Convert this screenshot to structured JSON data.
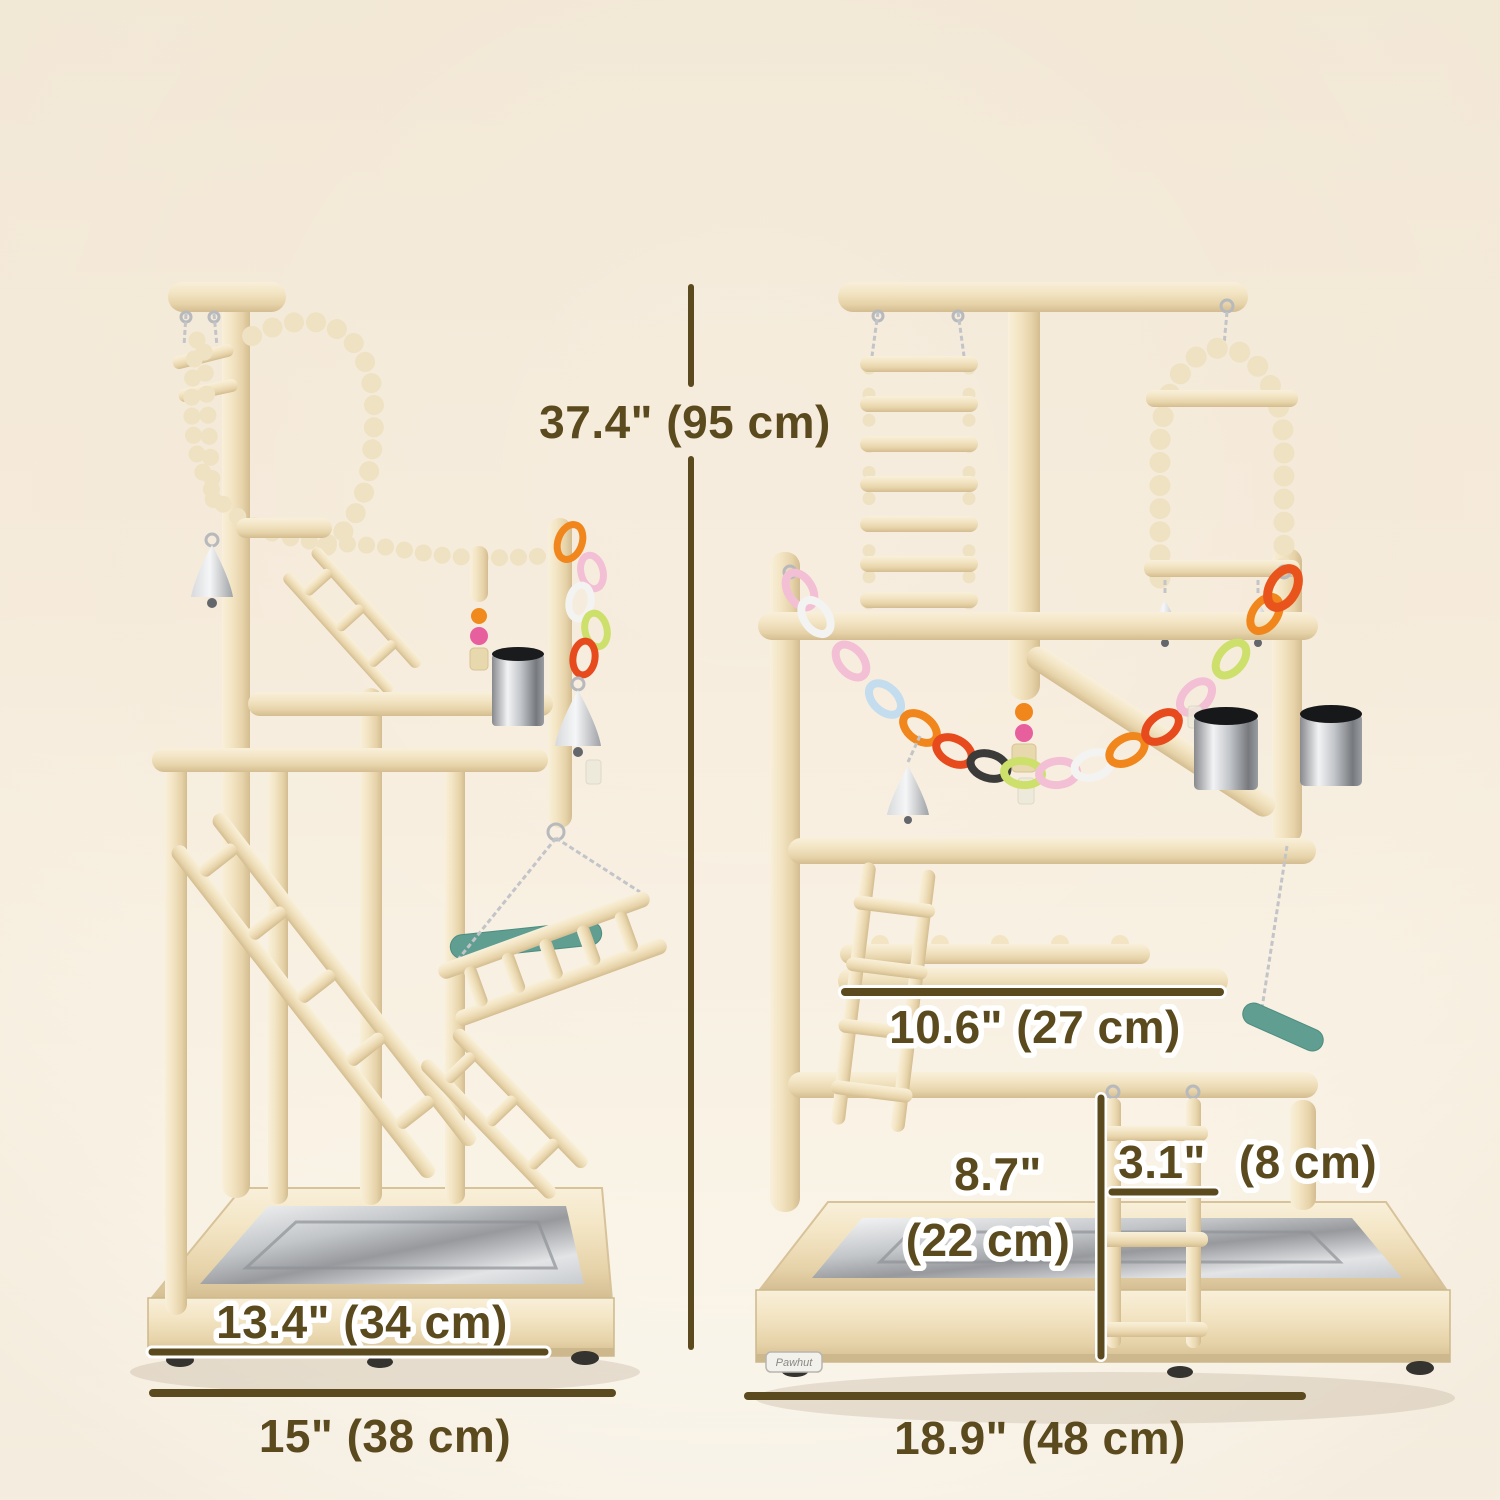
{
  "page": {
    "title": "Bird playground stand dimension diagram"
  },
  "theme": {
    "annotation_color": "#5b4a1e",
    "annotation_outline": "#ffffff",
    "background_top": "#f2e7d4",
    "background_bottom": "#fbf7ee",
    "wood_light": "#f9f0da",
    "wood_dark": "#d3bc90",
    "steel_color": "#c3c6c9",
    "teal_perch_color": "#5f9e90",
    "chain_colors": [
      "#f3f3f1",
      "#f3bfd4",
      "#c3dcee",
      "#f0861c",
      "#e64a1d",
      "#3b3b39",
      "#cde06c"
    ]
  },
  "views": {
    "side": {
      "name": "side view of bird play stand"
    },
    "front": {
      "name": "front view of bird play stand"
    }
  },
  "dimensions": {
    "overall_height": "37.4\" (95 cm)",
    "platform_length": "10.6\" (27 cm)",
    "ladder_height_value": "8.7\"",
    "ladder_height_metric": "(22 cm)",
    "ladder_width_value": "3.1\"",
    "ladder_width_metric": "(8 cm)",
    "base_depth": "13.4\" (34 cm)",
    "side_base_width": "15\" (38 cm)",
    "front_base_width": "18.9\" (48 cm)"
  },
  "brand": {
    "label": "Pawhut"
  }
}
